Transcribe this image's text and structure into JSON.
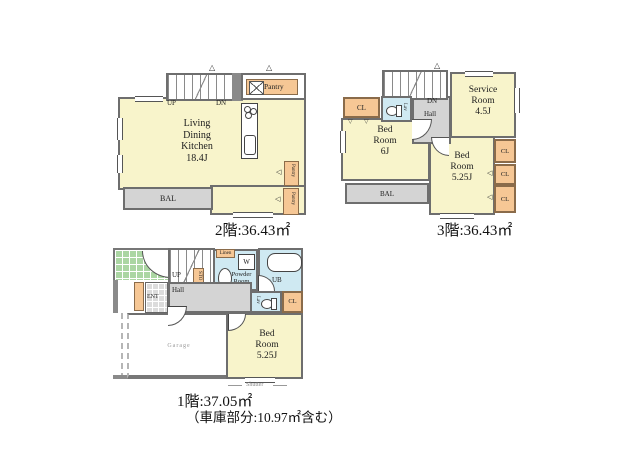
{
  "floor2": {
    "title": "2階:36.43㎡",
    "ldk_label": "Living\nDining\nKitchen\n18.4J",
    "pantry_label": "Pantry",
    "side_pantry1": "Pantry",
    "side_pantry2": "Pantry",
    "bal_label": "BAL",
    "up_label": "UP",
    "dn_label": "DN"
  },
  "floor3": {
    "title": "3階:36.43㎡",
    "service_label": "Service\nRoom\n4.5J",
    "bed6_label": "Bed\nRoom\n6J",
    "bed525_label": "Bed\nRoom\n5.25J",
    "cl_label": "CL",
    "lav_label": "Lav",
    "hall_label": "Hall",
    "dn_label": "DN",
    "bal_label": "BAL"
  },
  "floor1": {
    "title": "1階:37.05㎡",
    "subtitle": "（車庫部分:10.97㎡含む）",
    "powder_label": "Powder\nRoom",
    "ub_label": "UB",
    "linen_label": "Linen",
    "washer_label": "W",
    "sto_label": "STO",
    "up_label": "UP",
    "hall_label": "Hall",
    "ent_label": "ENT",
    "lav_label": "Lav",
    "cl_label": "CL",
    "bed_label": "Bed\nRoom\n5.25J",
    "garage_label": "Garage",
    "shutter_label": "Shutter"
  },
  "icons": {
    "roof_vent": "△",
    "swing_left": "◁",
    "swing_down": "▽"
  },
  "colors": {
    "room_yellow": "#F8F4CB",
    "closet_orange": "#F6C795",
    "water_blue": "#CFE9F2",
    "hall_gray": "#D4D4D4",
    "tile_green": "#ABD6A3",
    "wall_dark": "#6E6E6E"
  }
}
